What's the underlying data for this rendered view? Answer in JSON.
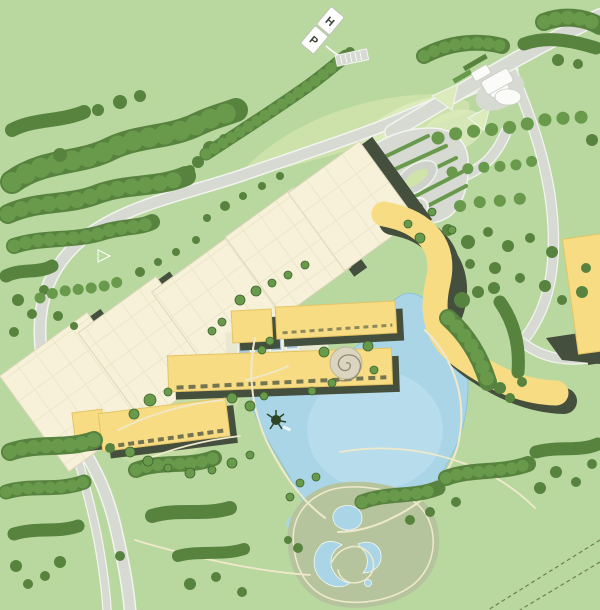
{
  "sign": {
    "letter_top": "H",
    "letter_bottom": "P"
  },
  "colors": {
    "bg": "#b9d89f",
    "lawn": "#cfe3ab",
    "lawn2": "#dcebbc",
    "lawnw": "#c6dea4",
    "sage": "#b6c49e",
    "tree": "#57833f",
    "tree2": "#699a4c",
    "treedark": "#3e652f",
    "road": "#d7d9d3",
    "roadedge": "#f3f4f0",
    "cream": "#f6f1d8",
    "creamline": "#dcd6ba",
    "yellow": "#f7dc83",
    "yellowline": "#e4c464",
    "shadow": "#454f3d",
    "water": "#a9d5e7",
    "water2": "#c6e3f0",
    "path": "#efe9cb",
    "hatch": "#e9e0a0",
    "sign_bg": "#ffffff",
    "sign_text": "#3b413a"
  },
  "features": [
    "forest",
    "perimeter-road",
    "highway-interchange",
    "gatehouse",
    "parking-lot",
    "warehouse-blocks",
    "campus-buildings",
    "glass-atrium",
    "serpentine-building",
    "east-building",
    "spiral-plaza",
    "lake",
    "water-garden",
    "sign-ph",
    "boundary-dashes"
  ]
}
